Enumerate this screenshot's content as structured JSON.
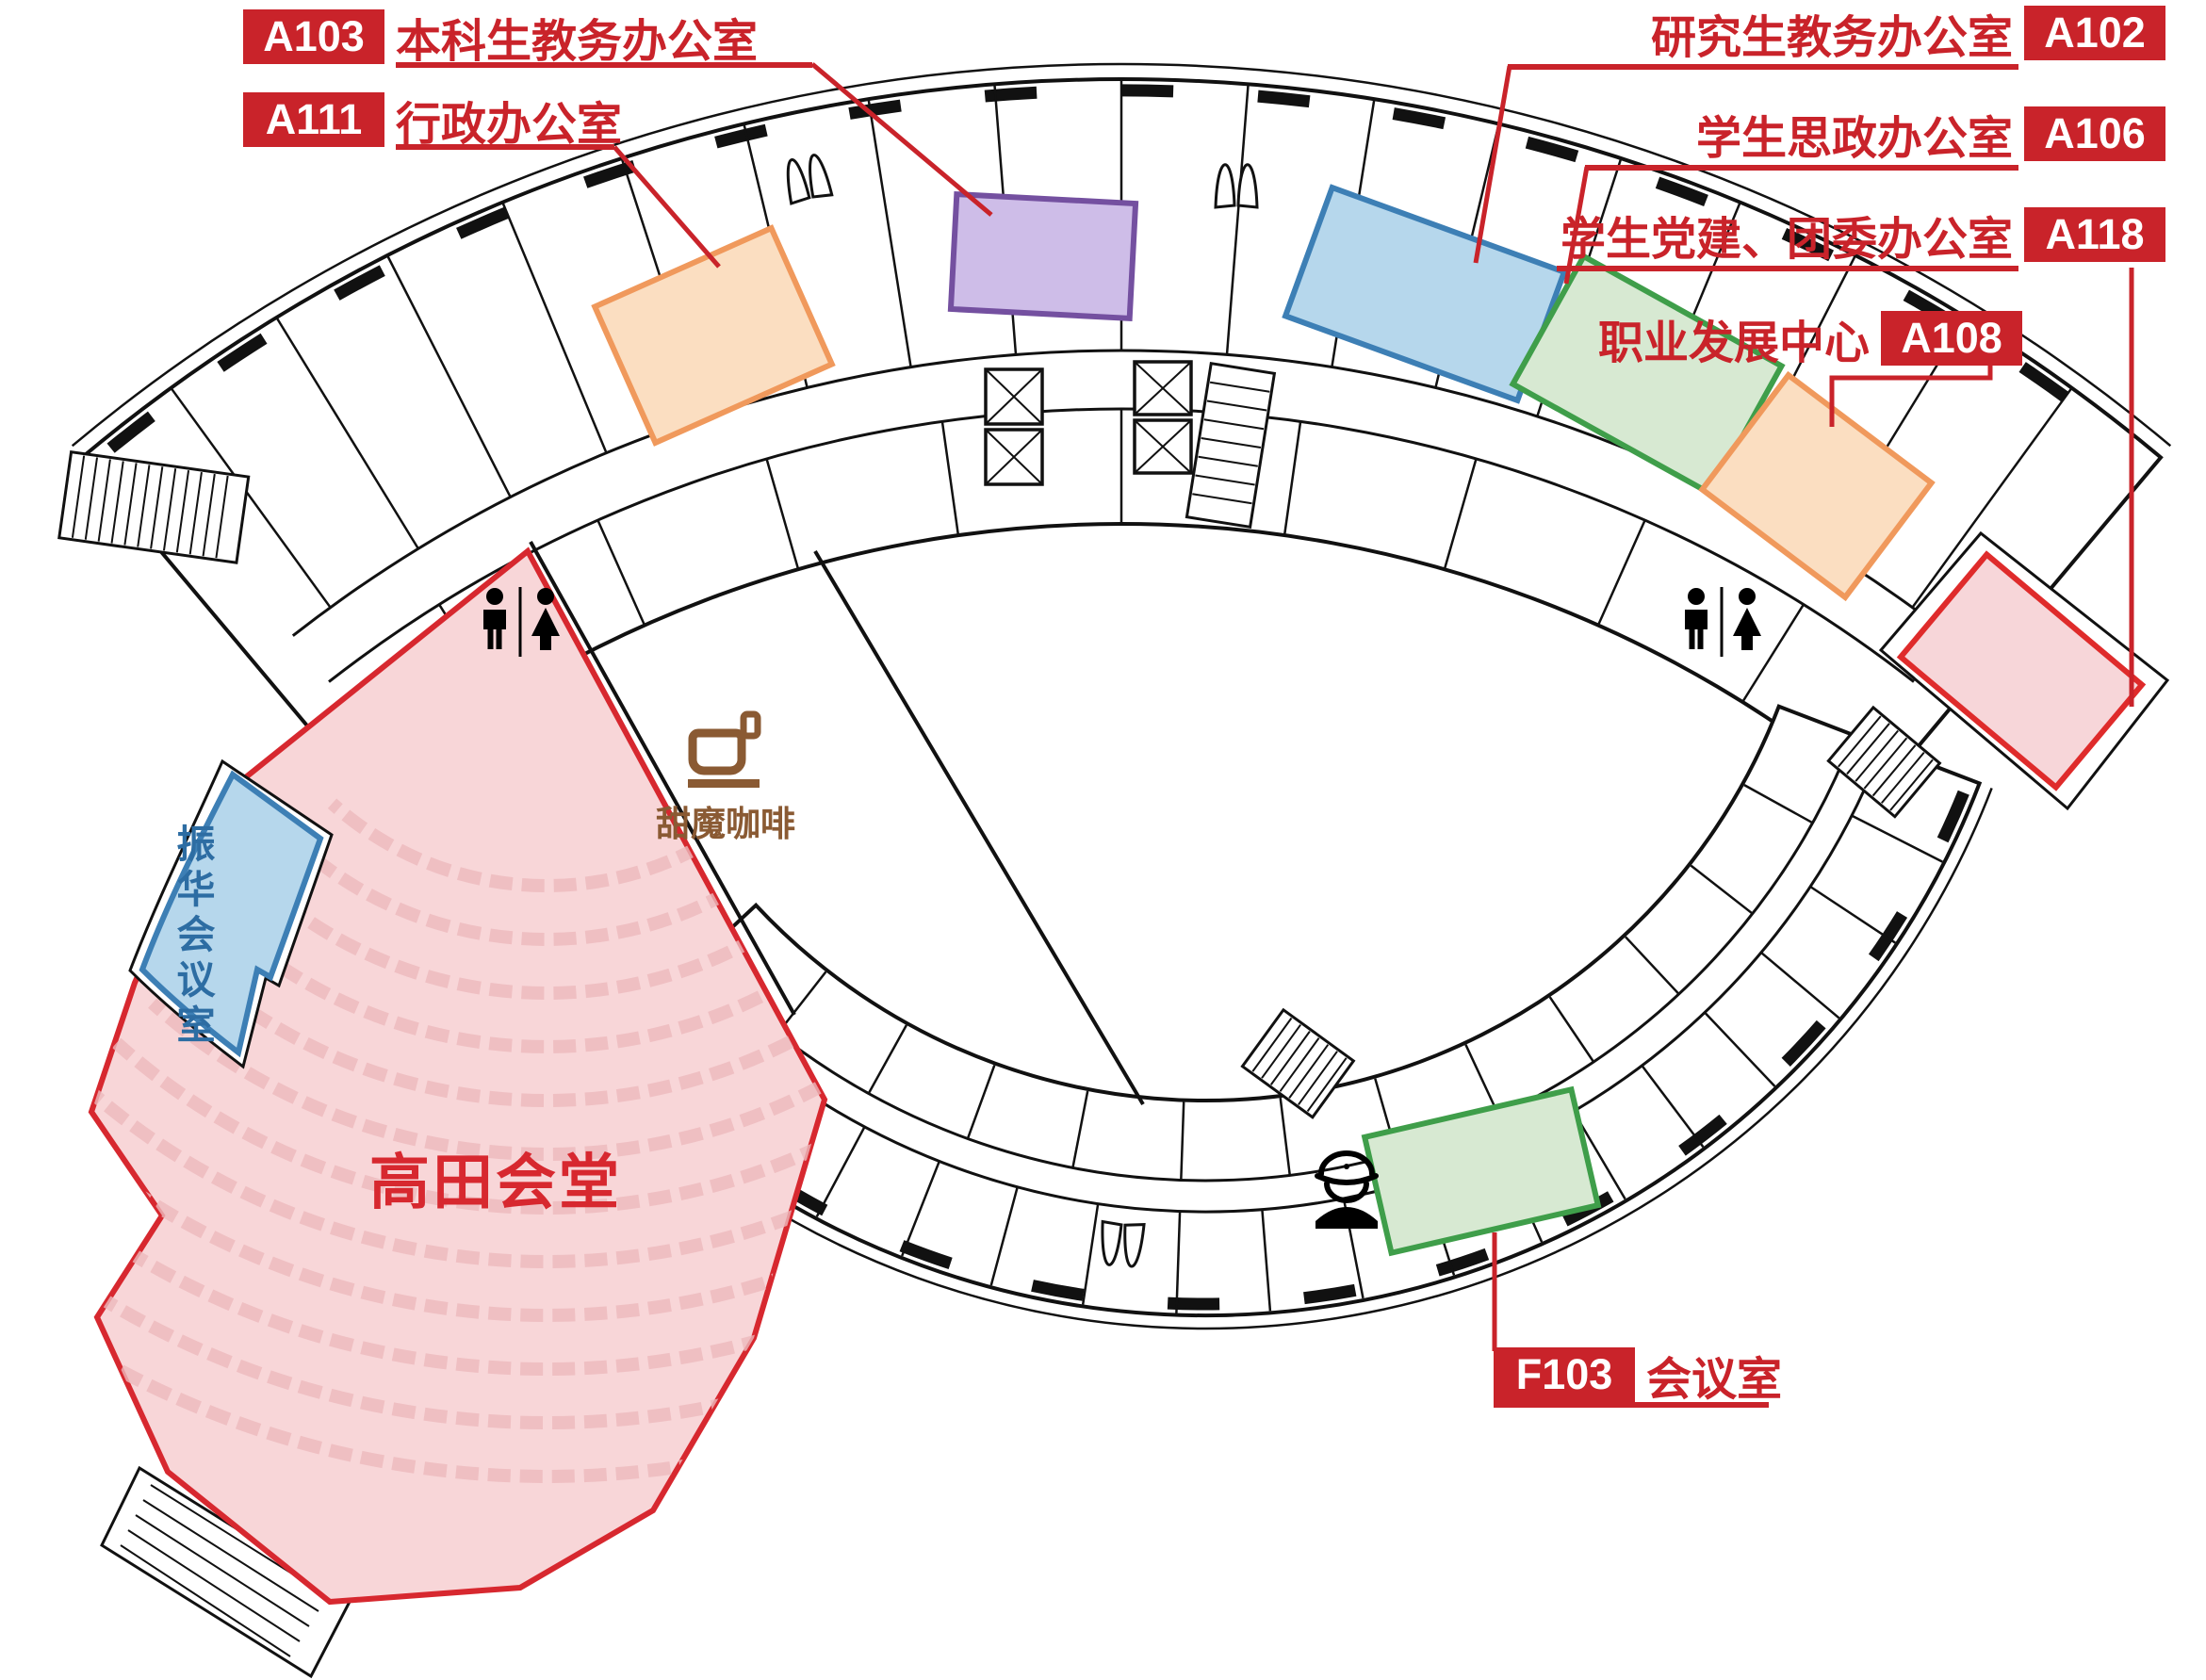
{
  "legend": {
    "left": [
      {
        "code": "A103",
        "name": "本科生教务办公室"
      },
      {
        "code": "A111",
        "name": "行政办公室"
      }
    ],
    "right": [
      {
        "code": "A102",
        "name": "研究生教务办公室"
      },
      {
        "code": "A106",
        "name": "学生思政办公室"
      },
      {
        "code": "A118",
        "name": "学生党建、团委办公室"
      },
      {
        "code": "A108",
        "name": "职业发展中心"
      }
    ],
    "bottom": [
      {
        "code": "F103",
        "name": "会议室"
      }
    ]
  },
  "areas": {
    "auditorium": "高田会堂",
    "meeting_room_left": "振华会议室",
    "cafe": "甜魔咖啡"
  },
  "colors": {
    "annotation_red": "#c9232a",
    "auditorium_fill": "#f8d6d8",
    "auditorium_stroke": "#d7282f",
    "purple_fill": "#cebde8",
    "purple_stroke": "#7450a0",
    "blue_fill": "#b6d7ec",
    "blue_stroke": "#3d7fb5",
    "green_fill": "#d7e9d2",
    "green_stroke": "#3f9e4a",
    "orange_fill": "#fbdec1",
    "orange_stroke": "#f0995c",
    "pink_fill": "#f7d6d9",
    "pink_stroke": "#df2b2b",
    "cafe_brown": "#8a5a33",
    "zhenhua_text": "#2d6da3",
    "wall_black": "#111111"
  }
}
